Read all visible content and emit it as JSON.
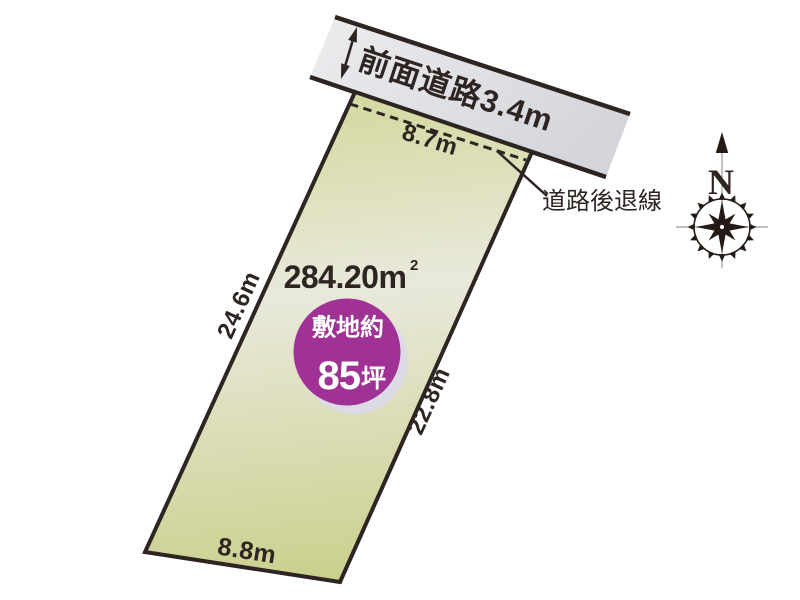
{
  "diagram": {
    "road": {
      "label": "前面道路3.4m"
    },
    "setback": {
      "label": "道路後退線",
      "frontage_dim": "8.7m"
    },
    "plot": {
      "area_value": "284.20m",
      "area_sup": "2",
      "left_dim": "24.6m",
      "right_dim": "22.8m",
      "bottom_dim": "8.8m"
    },
    "badge": {
      "line1": "敷地約",
      "value": "85",
      "unit": "坪"
    },
    "compass": {
      "north": "N"
    },
    "colors": {
      "outline": "#2e2522",
      "text": "#2e2522",
      "road_fill_light": "#ededef",
      "road_fill_dark": "#d4d5db",
      "plot_fill_top": "#d3d79b",
      "plot_fill_mid": "#e9e9dc",
      "plot_fill_bottom": "#cbd08d",
      "badge_fill": "#a03295",
      "badge_shadow": "#dcdae4"
    }
  }
}
